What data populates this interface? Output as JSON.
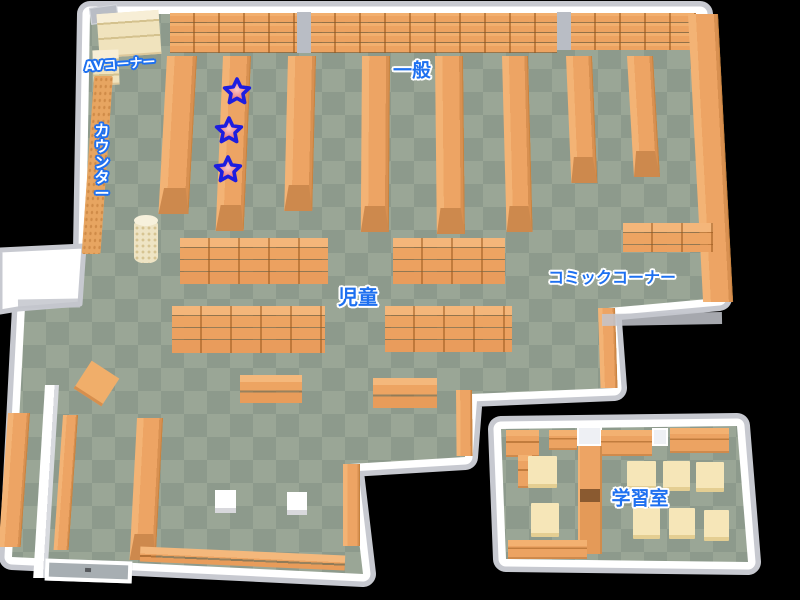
{
  "palette": {
    "background": "#000000",
    "wall_white": "#ffffff",
    "wall_gray": "#c7c9d0",
    "floor_light": "#9aa696",
    "floor_dark": "#8d9a8c",
    "shelf_orange": "#eda464",
    "shelf_dark": "#cd894d",
    "shelf_cream": "#f0e3bd",
    "desk_cream": "#f6e6b8",
    "label_blue": "#1e70f0",
    "label_white": "#ffffff",
    "star_red": "#e34b4b",
    "star_outline": "#1d1de0"
  },
  "rooms": {
    "main_floor": {
      "points": [
        [
          90,
          14
        ],
        [
          700,
          14
        ],
        [
          719,
          298
        ],
        [
          608,
          308
        ],
        [
          614,
          388
        ],
        [
          470,
          394
        ],
        [
          465,
          457
        ],
        [
          350,
          464
        ],
        [
          363,
          574
        ],
        [
          12,
          557
        ],
        [
          25,
          307
        ],
        [
          82,
          300
        ],
        [
          86,
          250
        ]
      ]
    },
    "study_room": {
      "points": [
        [
          501,
          429
        ],
        [
          737,
          426
        ],
        [
          748,
          562
        ],
        [
          506,
          559
        ]
      ]
    },
    "wall_block": {
      "points": [
        [
          0,
          250
        ],
        [
          84,
          246
        ],
        [
          80,
          304
        ],
        [
          18,
          309
        ],
        [
          0,
          312
        ]
      ]
    }
  },
  "labels": [
    {
      "text": "AVコーナー",
      "x": 120,
      "y": 65,
      "size": 13,
      "style": "white",
      "rot": -4
    },
    {
      "text": "カウンター",
      "x": 102,
      "y": 163,
      "size": 15,
      "style": "white",
      "vertical": true
    },
    {
      "text": "一般",
      "x": 412,
      "y": 71,
      "size": 19,
      "style": "blue"
    },
    {
      "text": "児童",
      "x": 358,
      "y": 297,
      "size": 20,
      "style": "blue"
    },
    {
      "text": "コミックコーナー",
      "x": 612,
      "y": 278,
      "size": 16,
      "style": "blue"
    },
    {
      "text": "学習室",
      "x": 640,
      "y": 499,
      "size": 19,
      "style": "blue"
    }
  ],
  "stars": {
    "outer_radius": 13,
    "inner_radius": 6.3,
    "points": [
      {
        "x": 237,
        "y": 92
      },
      {
        "x": 229,
        "y": 131
      },
      {
        "x": 228,
        "y": 170
      }
    ]
  },
  "furniture": [
    {
      "t": "bandshelf",
      "x": 170,
      "y": 12,
      "w": 127,
      "h": 41
    },
    {
      "t": "bandshelf",
      "x": 311,
      "y": 12,
      "w": 246,
      "h": 41
    },
    {
      "t": "bandshelf",
      "x": 571,
      "y": 12,
      "w": 125,
      "h": 38
    },
    {
      "t": "pillar",
      "x": 297,
      "y": 12,
      "w": 14,
      "h": 41
    },
    {
      "t": "pillar",
      "x": 557,
      "y": 12,
      "w": 14,
      "h": 38
    },
    {
      "t": "graydoor",
      "x": 90,
      "y": 6,
      "w": 28,
      "h": 17,
      "rot": -8
    },
    {
      "t": "cream",
      "x": 98,
      "y": 12,
      "w": 62,
      "h": 44,
      "rot": -4
    },
    {
      "t": "cream",
      "x": 93,
      "y": 50,
      "w": 26,
      "h": 35,
      "rot": -2
    },
    {
      "t": "counter",
      "x": 94,
      "y": 76,
      "w": 19,
      "h": 178,
      "skew": -4
    },
    {
      "t": "cylinder",
      "x": 134,
      "y": 219,
      "w": 24,
      "h": 44
    },
    {
      "t": "vshelf",
      "x": 167,
      "y": 56,
      "w": 30,
      "h": 158,
      "skew": -3.1,
      "cap": true
    },
    {
      "t": "vshelf",
      "x": 223,
      "y": 56,
      "w": 28,
      "h": 175,
      "skew": -2.4,
      "cap": true
    },
    {
      "t": "vshelf",
      "x": 288,
      "y": 56,
      "w": 28,
      "h": 155,
      "skew": -1.4,
      "cap": true
    },
    {
      "t": "vshelf",
      "x": 362,
      "y": 56,
      "w": 28,
      "h": 176,
      "skew": -0.4,
      "cap": true
    },
    {
      "t": "vshelf",
      "x": 435,
      "y": 56,
      "w": 28,
      "h": 178,
      "skew": 0.6,
      "cap": true
    },
    {
      "t": "vshelf",
      "x": 502,
      "y": 56,
      "w": 26,
      "h": 176,
      "skew": 1.5,
      "cap": true
    },
    {
      "t": "vshelf",
      "x": 566,
      "y": 56,
      "w": 26,
      "h": 127,
      "skew": 2.4,
      "cap": true
    },
    {
      "t": "vshelf",
      "x": 627,
      "y": 56,
      "w": 26,
      "h": 121,
      "skew": 3.3,
      "cap": true
    },
    {
      "t": "vshelf",
      "x": 688,
      "y": 14,
      "w": 30,
      "h": 288,
      "skew": 3.0,
      "cap": false
    },
    {
      "t": "vshelf",
      "x": 598,
      "y": 308,
      "w": 17,
      "h": 80,
      "skew": 1.8,
      "cap": false
    },
    {
      "t": "gridshelf",
      "x": 180,
      "y": 238,
      "w": 148,
      "h": 46
    },
    {
      "t": "gridshelf",
      "x": 393,
      "y": 238,
      "w": 112,
      "h": 46
    },
    {
      "t": "gridshelf",
      "x": 172,
      "y": 306,
      "w": 153,
      "h": 47
    },
    {
      "t": "gridshelf",
      "x": 385,
      "y": 306,
      "w": 127,
      "h": 46
    },
    {
      "t": "gridshelf",
      "x": 623,
      "y": 223,
      "w": 90,
      "h": 29
    },
    {
      "t": "lowshelf",
      "x": 240,
      "y": 375,
      "w": 62,
      "h": 28
    },
    {
      "t": "lowshelf",
      "x": 373,
      "y": 378,
      "w": 64,
      "h": 30
    },
    {
      "t": "sqtable",
      "x": 80,
      "y": 367,
      "w": 33,
      "h": 33,
      "rot": 33
    },
    {
      "t": "wallseg",
      "x": 45,
      "y": 385,
      "w": 14,
      "h": 193,
      "skew": -3.5
    },
    {
      "t": "vshelf",
      "x": 8,
      "y": 413,
      "w": 22,
      "h": 134,
      "skew": -4,
      "cap": false
    },
    {
      "t": "vshelf",
      "x": 63,
      "y": 415,
      "w": 15,
      "h": 135,
      "skew": -4,
      "cap": false
    },
    {
      "t": "vshelf",
      "x": 137,
      "y": 418,
      "w": 26,
      "h": 142,
      "skew": -3,
      "cap": true
    },
    {
      "t": "vshelf",
      "x": 456,
      "y": 390,
      "w": 16,
      "h": 66,
      "skew": 0.5,
      "cap": false
    },
    {
      "t": "vshelf",
      "x": 343,
      "y": 464,
      "w": 17,
      "h": 82,
      "skew": 0,
      "cap": false
    },
    {
      "t": "whitebox",
      "x": 215,
      "y": 490,
      "w": 21,
      "h": 23
    },
    {
      "t": "whitebox",
      "x": 287,
      "y": 492,
      "w": 20,
      "h": 23
    },
    {
      "t": "lowshelf",
      "x": 140,
      "y": 551,
      "w": 205,
      "h": 15,
      "rot": 2.5
    },
    {
      "t": "door",
      "x": 45,
      "y": 560,
      "w": 87,
      "h": 22,
      "rot": 2
    },
    {
      "t": "graystrip",
      "x": 602,
      "y": 313,
      "w": 120,
      "h": 12,
      "rot": -1
    },
    {
      "t": "graystrip",
      "x": 18,
      "y": 299,
      "w": 62,
      "h": 9,
      "rot": -1
    },
    {
      "t": "sshelf",
      "x": 506,
      "y": 430,
      "w": 33,
      "h": 27
    },
    {
      "t": "sshelf",
      "x": 549,
      "y": 430,
      "w": 28,
      "h": 20
    },
    {
      "t": "whitedoor",
      "x": 577,
      "y": 426,
      "w": 25,
      "h": 20
    },
    {
      "t": "sshelf",
      "x": 601,
      "y": 430,
      "w": 51,
      "h": 26
    },
    {
      "t": "whitedoor",
      "x": 652,
      "y": 428,
      "w": 16,
      "h": 18
    },
    {
      "t": "sshelf",
      "x": 670,
      "y": 428,
      "w": 59,
      "h": 25
    },
    {
      "t": "divider",
      "x": 578,
      "y": 446,
      "w": 24,
      "h": 108
    },
    {
      "t": "sshelf",
      "x": 518,
      "y": 455,
      "w": 14,
      "h": 33
    },
    {
      "t": "desk",
      "x": 528,
      "y": 456,
      "w": 29,
      "h": 32
    },
    {
      "t": "desk",
      "x": 531,
      "y": 503,
      "w": 28,
      "h": 34
    },
    {
      "t": "desk",
      "x": 627,
      "y": 461,
      "w": 29,
      "h": 29
    },
    {
      "t": "desk",
      "x": 663,
      "y": 461,
      "w": 27,
      "h": 30
    },
    {
      "t": "desk",
      "x": 696,
      "y": 462,
      "w": 28,
      "h": 30
    },
    {
      "t": "desk",
      "x": 633,
      "y": 508,
      "w": 27,
      "h": 31
    },
    {
      "t": "desk",
      "x": 669,
      "y": 508,
      "w": 26,
      "h": 31
    },
    {
      "t": "desk",
      "x": 704,
      "y": 510,
      "w": 25,
      "h": 31
    },
    {
      "t": "sshelf",
      "x": 508,
      "y": 540,
      "w": 79,
      "h": 19
    }
  ]
}
